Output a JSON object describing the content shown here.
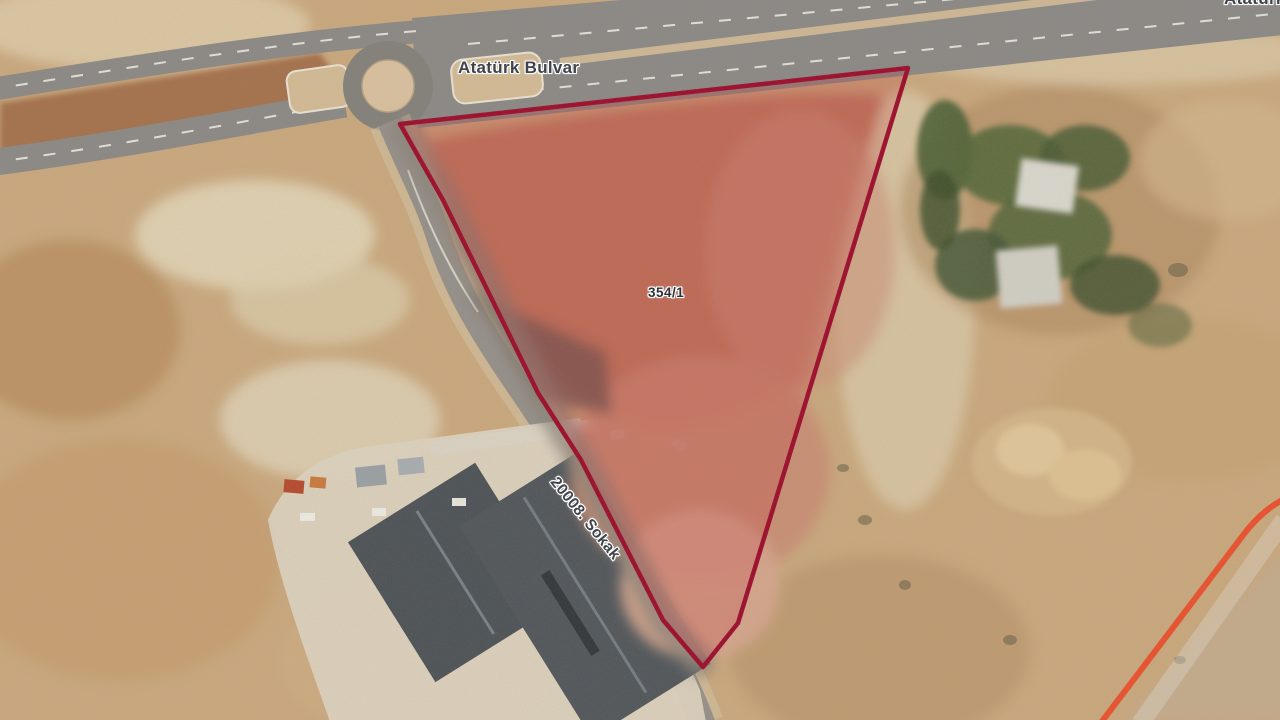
{
  "app": {
    "view": "satellite-map",
    "description": "Aerial cadastral map view with highlighted land parcel"
  },
  "map": {
    "labels": {
      "road_main": "Atatürk Bulvar",
      "road_main_clipped": "Atatürk",
      "street": "20008. Sokak",
      "parcel_no": "354/1"
    },
    "parcel": {
      "id": "354/1",
      "outline_color": "#9c0d2c",
      "fill_color": "rgba(195,28,46,0.20)"
    },
    "other_boundary": {
      "color": "#e8512e"
    },
    "features": {
      "roundabout": "roundabout",
      "highway": "dual carriageway boulevard",
      "building": "large dark-roofed building complex",
      "trees": "tree cluster",
      "terrain": "bare tan earth"
    }
  }
}
